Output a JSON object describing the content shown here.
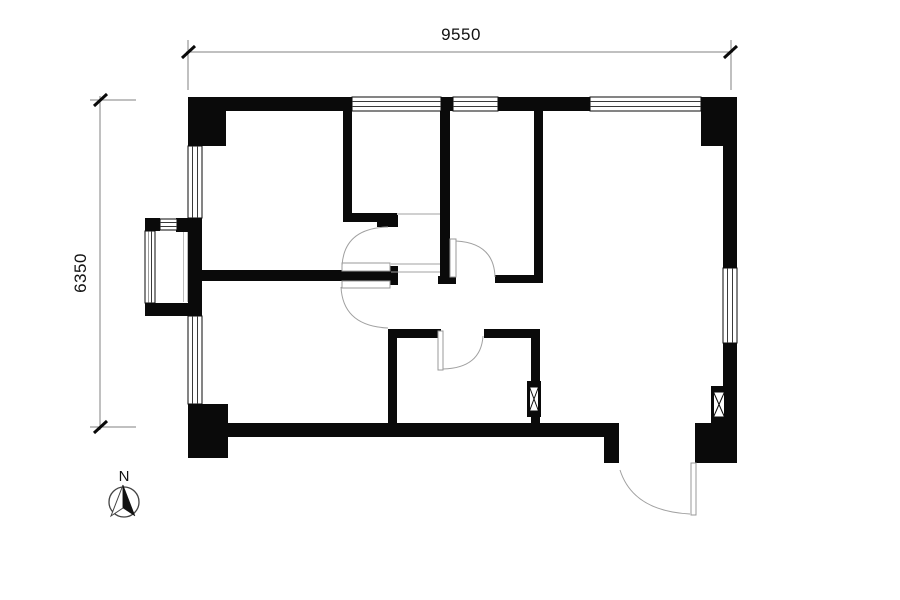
{
  "drawing": {
    "dimensions": {
      "top_label": "9550",
      "left_label": "6350"
    },
    "compass": {
      "north_label": "N"
    },
    "colors": {
      "wall": "#0a0a0a",
      "dimension_line": "#828282",
      "door_swing": "#a0a0a0",
      "window_line": "#3a3a3a",
      "background": "#ffffff"
    }
  }
}
